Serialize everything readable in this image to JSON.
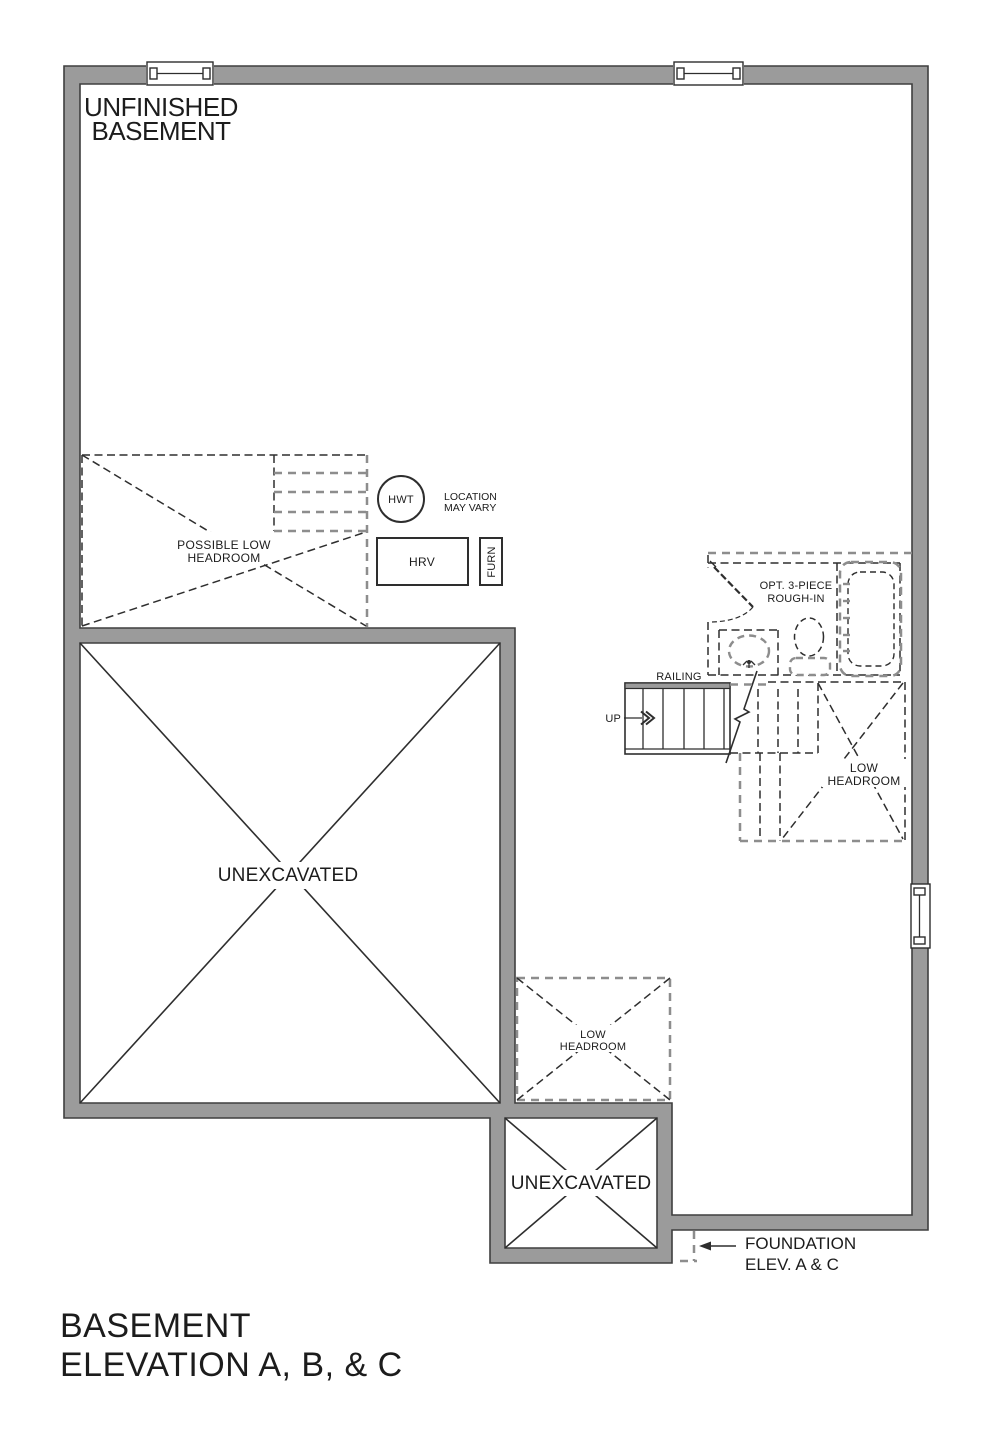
{
  "labels": {
    "room": {
      "l1": "UNFINISHED",
      "l2": "BASEMENT"
    },
    "possible_low_headroom": {
      "l1": "POSSIBLE LOW",
      "l2": "HEADROOM"
    },
    "hwt": "HWT",
    "location": {
      "l1": "LOCATION",
      "l2": "MAY VARY"
    },
    "hrv": "HRV",
    "furn": "FURN",
    "rough_in": {
      "l1": "OPT. 3-PIECE",
      "l2": "ROUGH-IN"
    },
    "railing": "RAILING",
    "up": "UP",
    "low_headroom_stairs": {
      "l1": "LOW",
      "l2": "HEADROOM"
    },
    "unexcavated_main": "UNEXCAVATED",
    "low_headroom_mid": {
      "l1": "LOW",
      "l2": "HEADROOM"
    },
    "unexcavated_small": "UNEXCAVATED",
    "foundation": {
      "l1": "FOUNDATION",
      "l2": "ELEV. A & C"
    }
  },
  "title": {
    "l1": "BASEMENT",
    "l2": "ELEVATION A, B, & C"
  },
  "colors": {
    "wall_fill": "#9b9b9b",
    "wall_stroke": "#3f3f3f",
    "line_dark": "#2e2e2e",
    "line_gray": "#8d8d8d",
    "text": "#1c1c1c",
    "background": "#ffffff"
  }
}
